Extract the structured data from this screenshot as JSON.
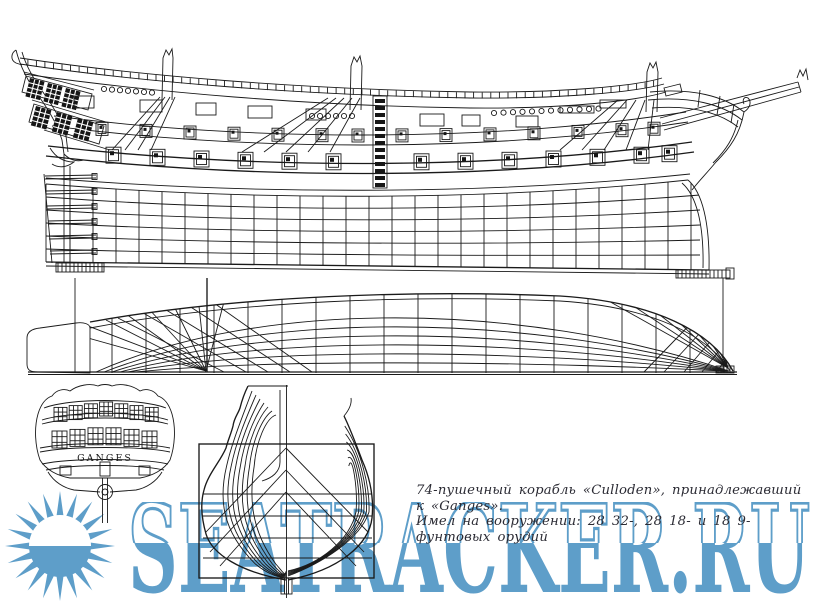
{
  "blueprint": {
    "stern_name": "GANGES",
    "caption_line1": "74-пушечный корабль «Culloden», принадлежавший к «Ganges».",
    "caption_line2": "Имел на вооружении: 28 32-, 28 18- и 18 9-фунтовых орудий"
  },
  "watermark": {
    "text": "SEATRACKER.RU",
    "color": "#5e9ec9",
    "logo": "sun-icon"
  },
  "colors": {
    "ink": "#1a1a1a",
    "paper": "#ffffff",
    "watermark_blue": "#5e9ec9"
  }
}
